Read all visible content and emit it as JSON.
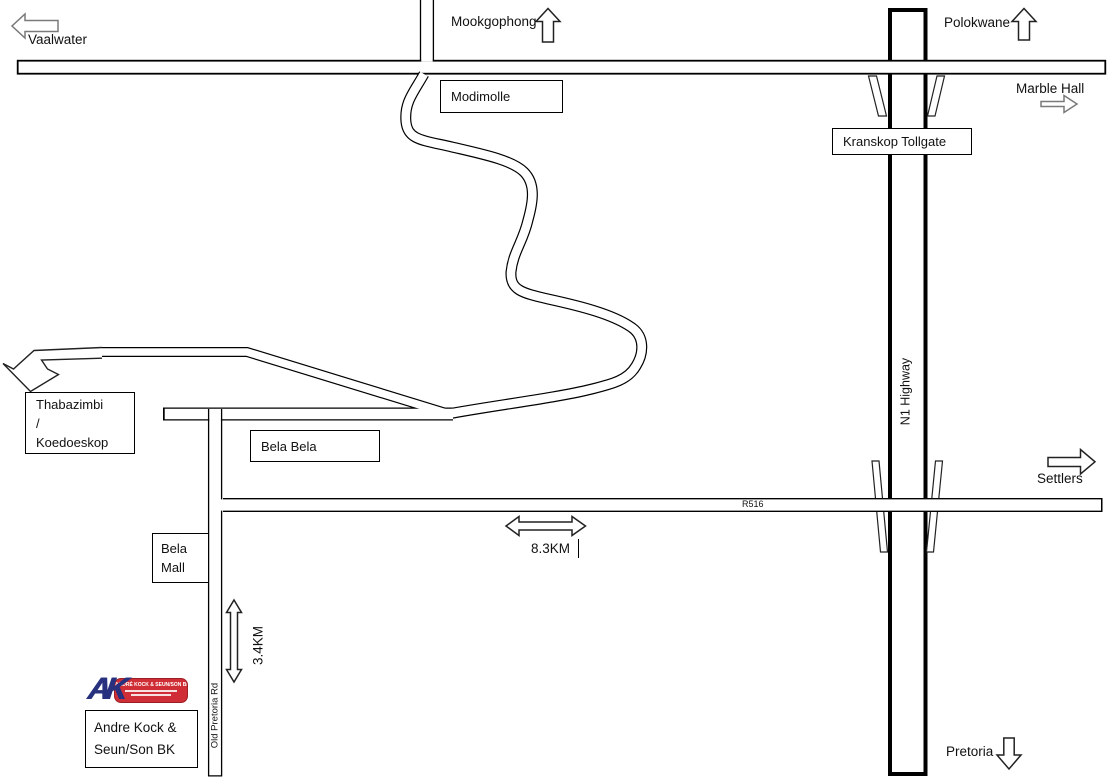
{
  "labels": {
    "vaalwater": "Vaalwater",
    "mookgophong": "Mookgophong",
    "polokwane": "Polokwane",
    "marble_hall": "Marble Hall",
    "settlers": "Settlers",
    "pretoria": "Pretoria"
  },
  "boxes": {
    "modimolle": "Modimolle",
    "kranskop_tollgate": "Kranskop Tollgate",
    "thabazimbi_line1": "Thabazimbi",
    "thabazimbi_line2": "/",
    "thabazimbi_line3": "Koedoeskop",
    "bela_bela": "Bela Bela",
    "bela_mall_line1": "Bela",
    "bela_mall_line2": "Mall",
    "andre_kock_line1": "Andre Kock &",
    "andre_kock_line2": "Seun/Son BK"
  },
  "roads": {
    "n1_highway": "N1 Highway",
    "r516": "R516",
    "old_pretoria_rd": "Old Pretoria Rd"
  },
  "distances": {
    "r516_segment": "8.3KM",
    "old_pretoria_segment": "3.4KM"
  },
  "logo": {
    "monogram": "AK",
    "banner_text": "ANDRÉ KOCK & SEUN/SON BK",
    "colors": {
      "navy": "#27317e",
      "red": "#cf2e36"
    }
  }
}
